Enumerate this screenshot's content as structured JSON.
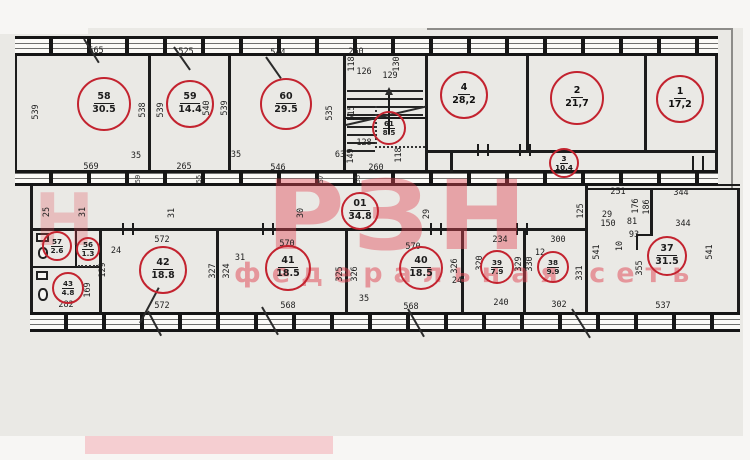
{
  "watermark": {
    "letters": "РЗН",
    "letter_partial": "Н",
    "subtitle": "федеральная сеть",
    "color": "#e14553"
  },
  "plan": {
    "circle_color": "#c3232f",
    "rooms": [
      {
        "num": "58",
        "area": "30.5",
        "cx": 104,
        "cy": 104,
        "r": 27
      },
      {
        "num": "59",
        "area": "14.4",
        "cx": 190,
        "cy": 104,
        "r": 24
      },
      {
        "num": "60",
        "area": "29.5",
        "cx": 286,
        "cy": 104,
        "r": 26
      },
      {
        "num": "61",
        "area": "8.5",
        "cx": 389,
        "cy": 128,
        "r": 17,
        "small": true
      },
      {
        "num": "4",
        "area": "28,2",
        "cx": 464,
        "cy": 95,
        "r": 24,
        "bold": true
      },
      {
        "num": "2",
        "area": "21,7",
        "cx": 577,
        "cy": 98,
        "r": 27,
        "bold": true
      },
      {
        "num": "1",
        "area": "17,2",
        "cx": 680,
        "cy": 99,
        "r": 24,
        "bold": true
      },
      {
        "num": "3",
        "area": "10,4",
        "cx": 564,
        "cy": 163,
        "r": 15,
        "small": true,
        "bold": true
      },
      {
        "num": "01",
        "area": "34.8",
        "cx": 360,
        "cy": 211,
        "r": 19
      },
      {
        "num": "42",
        "area": "18.8",
        "cx": 163,
        "cy": 270,
        "r": 24
      },
      {
        "num": "41",
        "area": "18.5",
        "cx": 288,
        "cy": 268,
        "r": 23
      },
      {
        "num": "40",
        "area": "18.5",
        "cx": 421,
        "cy": 268,
        "r": 22
      },
      {
        "num": "39",
        "area": "7.9",
        "cx": 497,
        "cy": 267,
        "r": 17,
        "small": true
      },
      {
        "num": "38",
        "area": "9.9",
        "cx": 553,
        "cy": 267,
        "r": 16,
        "small": true
      },
      {
        "num": "37",
        "area": "31.5",
        "cx": 667,
        "cy": 256,
        "r": 20
      },
      {
        "num": "57",
        "area": "2.6",
        "cx": 57,
        "cy": 246,
        "r": 15,
        "small": true
      },
      {
        "num": "56",
        "area": "1.3",
        "cx": 88,
        "cy": 249,
        "r": 12,
        "small": true
      },
      {
        "num": "43",
        "area": "4.8",
        "cx": 68,
        "cy": 288,
        "r": 16,
        "small": true
      }
    ],
    "dims": [
      {
        "t": "565",
        "x": 96,
        "y": 51
      },
      {
        "t": "525",
        "x": 186,
        "y": 52
      },
      {
        "t": "544",
        "x": 278,
        "y": 53
      },
      {
        "t": "260",
        "x": 356,
        "y": 52
      },
      {
        "t": "539",
        "x": 36,
        "y": 112,
        "r": 1
      },
      {
        "t": "538",
        "x": 143,
        "y": 110,
        "r": 1
      },
      {
        "t": "539",
        "x": 161,
        "y": 110,
        "r": 1
      },
      {
        "t": "540",
        "x": 207,
        "y": 108,
        "r": 1
      },
      {
        "t": "539",
        "x": 225,
        "y": 108,
        "r": 1
      },
      {
        "t": "535",
        "x": 330,
        "y": 113,
        "r": 1
      },
      {
        "t": "515",
        "x": 352,
        "y": 113,
        "r": 1
      },
      {
        "t": "118",
        "x": 352,
        "y": 64,
        "r": 1
      },
      {
        "t": "126",
        "x": 364,
        "y": 72
      },
      {
        "t": "129",
        "x": 390,
        "y": 76
      },
      {
        "t": "130",
        "x": 397,
        "y": 64,
        "r": 1
      },
      {
        "t": "128",
        "x": 364,
        "y": 143
      },
      {
        "t": "149",
        "x": 351,
        "y": 156,
        "r": 1
      },
      {
        "t": "118",
        "x": 399,
        "y": 155,
        "r": 1
      },
      {
        "t": "260",
        "x": 376,
        "y": 168
      },
      {
        "t": "63",
        "x": 340,
        "y": 155
      },
      {
        "t": "569",
        "x": 91,
        "y": 167
      },
      {
        "t": "35",
        "x": 136,
        "y": 156
      },
      {
        "t": "265",
        "x": 184,
        "y": 167
      },
      {
        "t": "35",
        "x": 236,
        "y": 155
      },
      {
        "t": "546",
        "x": 278,
        "y": 168
      },
      {
        "t": "59",
        "x": 138,
        "y": 179,
        "r": 1,
        "s": 1
      },
      {
        "t": "55",
        "x": 199,
        "y": 179,
        "r": 1,
        "s": 1
      },
      {
        "t": "57",
        "x": 321,
        "y": 179,
        "r": 1,
        "s": 1
      },
      {
        "t": "55",
        "x": 358,
        "y": 179,
        "r": 1,
        "s": 1
      },
      {
        "t": "344",
        "x": 681,
        "y": 193
      },
      {
        "t": "25",
        "x": 47,
        "y": 212,
        "r": 1
      },
      {
        "t": "31",
        "x": 83,
        "y": 212,
        "r": 1
      },
      {
        "t": "31",
        "x": 172,
        "y": 213,
        "r": 1
      },
      {
        "t": "30",
        "x": 301,
        "y": 213,
        "r": 1
      },
      {
        "t": "29",
        "x": 427,
        "y": 214,
        "r": 1
      },
      {
        "t": "251",
        "x": 618,
        "y": 192
      },
      {
        "t": "125",
        "x": 581,
        "y": 211,
        "r": 1
      },
      {
        "t": "29",
        "x": 607,
        "y": 215
      },
      {
        "t": "150",
        "x": 608,
        "y": 224
      },
      {
        "t": "176",
        "x": 636,
        "y": 206,
        "r": 1
      },
      {
        "t": "186",
        "x": 647,
        "y": 207,
        "r": 1
      },
      {
        "t": "81",
        "x": 632,
        "y": 222
      },
      {
        "t": "93",
        "x": 634,
        "y": 235
      },
      {
        "t": "10",
        "x": 620,
        "y": 246,
        "r": 1
      },
      {
        "t": "344",
        "x": 683,
        "y": 224
      },
      {
        "t": "541",
        "x": 710,
        "y": 252,
        "r": 1
      },
      {
        "t": "541",
        "x": 597,
        "y": 252,
        "r": 1
      },
      {
        "t": "355",
        "x": 640,
        "y": 268,
        "r": 1
      },
      {
        "t": "537",
        "x": 663,
        "y": 306
      },
      {
        "t": "572",
        "x": 162,
        "y": 240
      },
      {
        "t": "570",
        "x": 287,
        "y": 244
      },
      {
        "t": "570",
        "x": 413,
        "y": 247
      },
      {
        "t": "31",
        "x": 240,
        "y": 258
      },
      {
        "t": "327",
        "x": 213,
        "y": 271,
        "r": 1
      },
      {
        "t": "324",
        "x": 227,
        "y": 271,
        "r": 1
      },
      {
        "t": "325",
        "x": 340,
        "y": 274,
        "r": 1
      },
      {
        "t": "326",
        "x": 355,
        "y": 274,
        "r": 1
      },
      {
        "t": "326",
        "x": 455,
        "y": 266,
        "r": 1
      },
      {
        "t": "24",
        "x": 457,
        "y": 281
      },
      {
        "t": "234",
        "x": 500,
        "y": 240
      },
      {
        "t": "320",
        "x": 480,
        "y": 263,
        "r": 1
      },
      {
        "t": "329",
        "x": 519,
        "y": 264,
        "r": 1
      },
      {
        "t": "300",
        "x": 558,
        "y": 240
      },
      {
        "t": "12",
        "x": 540,
        "y": 253
      },
      {
        "t": "330",
        "x": 530,
        "y": 264,
        "r": 1
      },
      {
        "t": "331",
        "x": 580,
        "y": 273,
        "r": 1
      },
      {
        "t": "240",
        "x": 501,
        "y": 303
      },
      {
        "t": "302",
        "x": 559,
        "y": 305
      },
      {
        "t": "24",
        "x": 116,
        "y": 251
      },
      {
        "t": "129",
        "x": 103,
        "y": 270,
        "r": 1
      },
      {
        "t": "169",
        "x": 88,
        "y": 290,
        "r": 1
      },
      {
        "t": "282",
        "x": 66,
        "y": 305
      },
      {
        "t": "572",
        "x": 162,
        "y": 306
      },
      {
        "t": "568",
        "x": 288,
        "y": 306
      },
      {
        "t": "35",
        "x": 364,
        "y": 299
      },
      {
        "t": "568",
        "x": 411,
        "y": 307
      }
    ]
  }
}
